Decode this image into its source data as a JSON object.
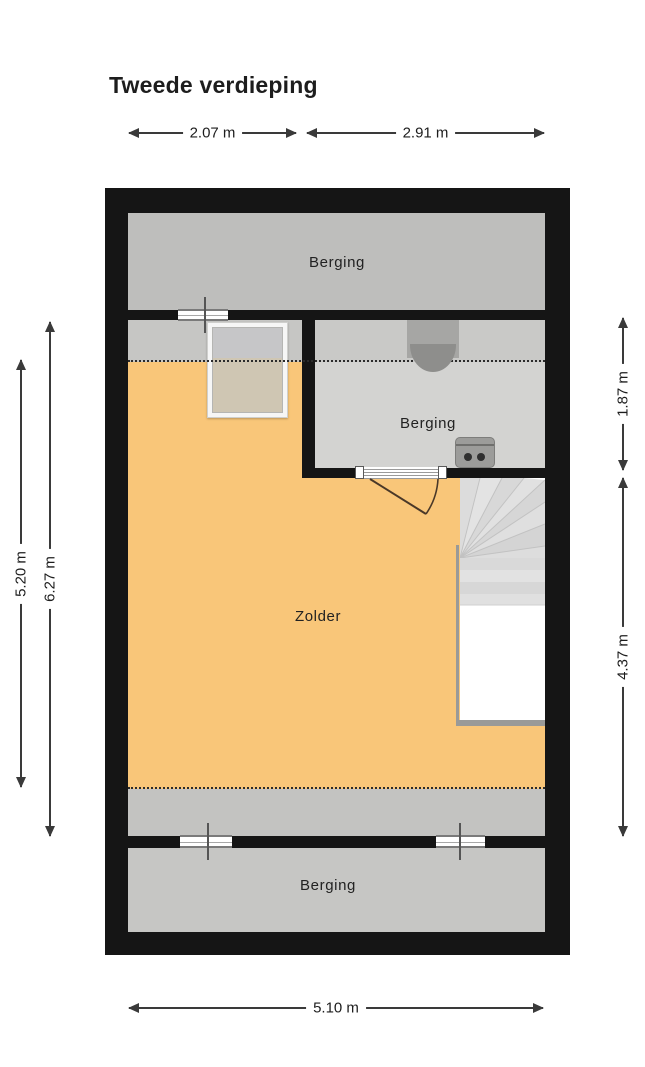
{
  "title": "Tweede verdieping",
  "floorplan": {
    "rooms": [
      {
        "id": "berging-top",
        "label": "Berging"
      },
      {
        "id": "berging-middle",
        "label": "Berging"
      },
      {
        "id": "zolder",
        "label": "Zolder"
      },
      {
        "id": "berging-bottom",
        "label": "Berging"
      }
    ],
    "dimensions": {
      "top_left": "2.07 m",
      "top_right": "2.91 m",
      "left_inner": "5.20 m",
      "left_outer": "6.27 m",
      "right_top": "1.87 m",
      "right_bottom": "4.37 m",
      "bottom": "5.10 m"
    },
    "objects": {
      "staircase": "winder-staircase",
      "door": "door-swing",
      "skylight": "skylight-window",
      "flue": "flue-duct",
      "ventilation_unit": "ventilation-unit",
      "window": "window-symbol"
    },
    "colors": {
      "wall": "#151515",
      "attic_floor": "#f9c679",
      "storage_gray": "#bebebc",
      "storage_light": "#d3d3d1",
      "low_headroom_gray": "#c6c6c4"
    }
  }
}
